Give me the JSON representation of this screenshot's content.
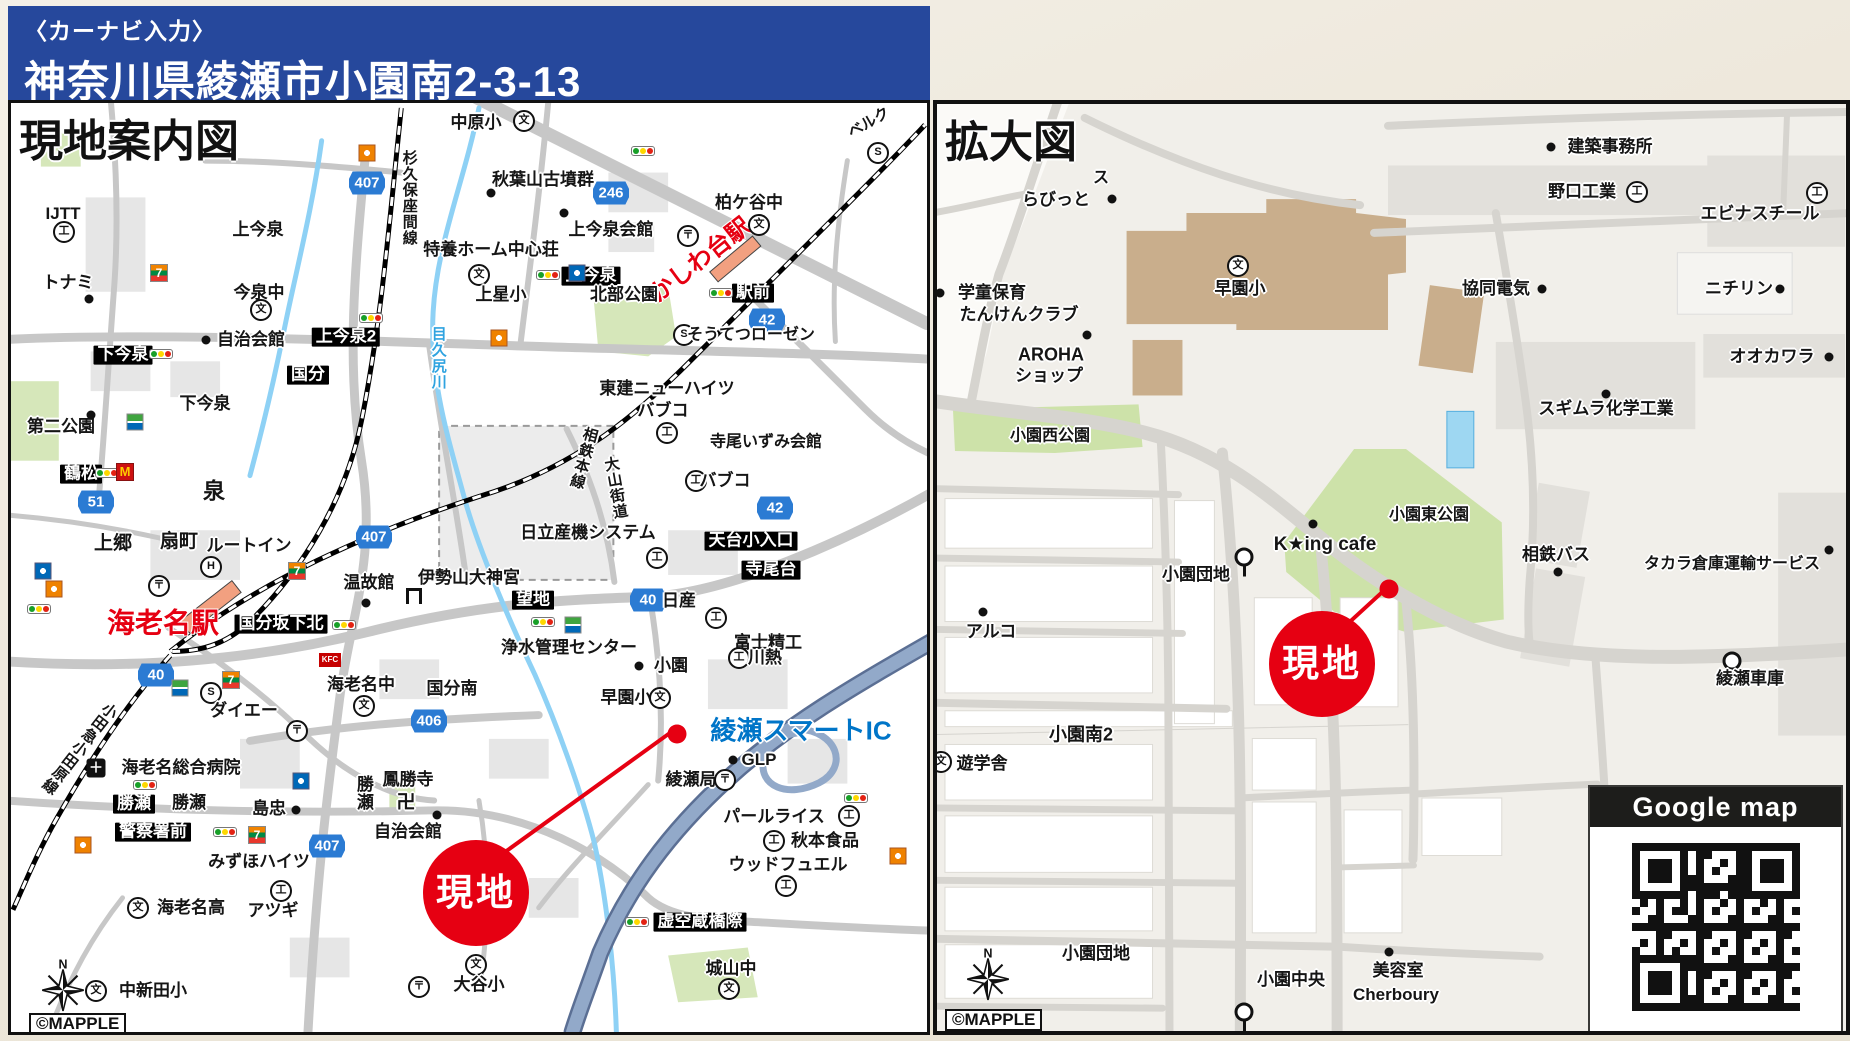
{
  "header": {
    "subtitle": "〈カーナビ入力〉",
    "title": "神奈川県綾瀬市小園南2-3-13"
  },
  "left_map": {
    "title": "現地案内図",
    "credit": "©MAPPLE",
    "labels": [
      {
        "k": "shield",
        "t": "407",
        "x": 356,
        "y": 80
      },
      {
        "k": "shield",
        "t": "246",
        "x": 600,
        "y": 90
      },
      {
        "k": "shield",
        "t": "42",
        "x": 756,
        "y": 217
      },
      {
        "k": "shield",
        "t": "51",
        "x": 85,
        "y": 399
      },
      {
        "k": "shield",
        "t": "407",
        "x": 363,
        "y": 434
      },
      {
        "k": "shield",
        "t": "40",
        "x": 145,
        "y": 572
      },
      {
        "k": "shield",
        "t": "40",
        "x": 637,
        "y": 497
      },
      {
        "k": "shield",
        "t": "42",
        "x": 764,
        "y": 405
      },
      {
        "k": "shield",
        "t": "406",
        "x": 418,
        "y": 618
      },
      {
        "k": "shield",
        "t": "407",
        "x": 316,
        "y": 743
      },
      {
        "k": "box",
        "t": "下今泉",
        "x": 112,
        "y": 252
      },
      {
        "k": "box",
        "t": "上今泉2",
        "x": 335,
        "y": 234
      },
      {
        "k": "box",
        "t": "国分",
        "x": 297,
        "y": 272
      },
      {
        "k": "box",
        "t": "鶴松",
        "x": 70,
        "y": 371
      },
      {
        "k": "box",
        "t": "上今泉",
        "x": 580,
        "y": 173
      },
      {
        "k": "box",
        "t": "駅前",
        "x": 742,
        "y": 190
      },
      {
        "k": "box",
        "t": "国分坂下北",
        "x": 270,
        "y": 521
      },
      {
        "k": "box",
        "t": "望地",
        "x": 522,
        "y": 497
      },
      {
        "k": "box",
        "t": "天台小入口",
        "x": 740,
        "y": 438
      },
      {
        "k": "box",
        "t": "寺尾台",
        "x": 760,
        "y": 467
      },
      {
        "k": "box",
        "t": "勝瀬",
        "x": 123,
        "y": 701
      },
      {
        "k": "box",
        "t": "警察署前",
        "x": 142,
        "y": 729
      },
      {
        "k": "box",
        "t": "虚空蔵橋際",
        "x": 689,
        "y": 819
      },
      {
        "k": "red",
        "t": "海老名駅",
        "x": 152,
        "y": 520,
        "s": 28
      },
      {
        "k": "red",
        "t": "かしわ台駅",
        "x": 690,
        "y": 158,
        "s": 24,
        "r": -38
      },
      {
        "k": "blue",
        "t": "綾瀬スマートIC",
        "x": 790,
        "y": 628,
        "s": 26
      },
      {
        "k": "rv",
        "t": "目久尻川",
        "x": 427,
        "y": 255,
        "s": 15
      },
      {
        "k": "v",
        "t": "杉久保座間線",
        "x": 398,
        "y": 95,
        "s": 15
      },
      {
        "k": "v",
        "t": "相鉄本線",
        "x": 572,
        "y": 355,
        "s": 15,
        "r": 15
      },
      {
        "k": "v",
        "t": "大山街道",
        "x": 604,
        "y": 385,
        "s": 15,
        "r": -10
      },
      {
        "k": "v",
        "t": "小田急小田原線",
        "x": 68,
        "y": 645,
        "s": 15,
        "r": 38
      },
      {
        "k": "v",
        "t": "勝瀬",
        "x": 352,
        "y": 690
      },
      {
        "k": "p",
        "t": "ベルク",
        "x": 858,
        "y": 20,
        "s": 15,
        "r": -30
      },
      {
        "k": "mark",
        "t": "S",
        "x": 867,
        "y": 50
      },
      {
        "k": "p",
        "t": "中原小",
        "x": 465,
        "y": 20
      },
      {
        "k": "mark",
        "t": "文",
        "x": 513,
        "y": 18
      },
      {
        "k": "p",
        "t": "秋葉山古墳群",
        "x": 532,
        "y": 77
      },
      {
        "k": "dot",
        "x": 480,
        "y": 90
      },
      {
        "k": "dot",
        "x": 553,
        "y": 110
      },
      {
        "k": "p",
        "t": "上今泉会館",
        "x": 600,
        "y": 127
      },
      {
        "k": "p",
        "t": "特養ホーム中心荘",
        "x": 480,
        "y": 147
      },
      {
        "k": "mark",
        "t": "文",
        "x": 468,
        "y": 172
      },
      {
        "k": "p",
        "t": "上星小",
        "x": 490,
        "y": 192
      },
      {
        "k": "p",
        "t": "北部公園",
        "x": 613,
        "y": 192
      },
      {
        "k": "p",
        "t": "柏ケ谷中",
        "x": 738,
        "y": 100
      },
      {
        "k": "mark",
        "t": "文",
        "x": 748,
        "y": 122
      },
      {
        "k": "mark",
        "t": "S",
        "x": 673,
        "y": 232
      },
      {
        "k": "p",
        "t": "そうてつローゼン",
        "x": 740,
        "y": 233,
        "s": 16
      },
      {
        "k": "p",
        "t": "東建ニューハイツ",
        "x": 656,
        "y": 286
      },
      {
        "k": "p",
        "t": "バブコ",
        "x": 652,
        "y": 308
      },
      {
        "k": "mark",
        "t": "工",
        "x": 656,
        "y": 330
      },
      {
        "k": "p",
        "t": "寺尾いずみ会館",
        "x": 755,
        "y": 340,
        "s": 16
      },
      {
        "k": "mark",
        "t": "工",
        "x": 685,
        "y": 378
      },
      {
        "k": "p",
        "t": "バブコ",
        "x": 714,
        "y": 378
      },
      {
        "k": "p",
        "t": "IJTT",
        "x": 52,
        "y": 111
      },
      {
        "k": "mark",
        "t": "工",
        "x": 53,
        "y": 129
      },
      {
        "k": "p",
        "t": "トナミ",
        "x": 57,
        "y": 180
      },
      {
        "k": "dot",
        "x": 78,
        "y": 196
      },
      {
        "k": "p",
        "t": "上今泉",
        "x": 247,
        "y": 127
      },
      {
        "k": "p",
        "t": "今泉中",
        "x": 248,
        "y": 190
      },
      {
        "k": "mark",
        "t": "文",
        "x": 250,
        "y": 207
      },
      {
        "k": "p",
        "t": "自治会館",
        "x": 240,
        "y": 237
      },
      {
        "k": "dot",
        "x": 195,
        "y": 237
      },
      {
        "k": "p",
        "t": "下今泉",
        "x": 194,
        "y": 301
      },
      {
        "k": "p",
        "t": "第二公園",
        "x": 50,
        "y": 324
      },
      {
        "k": "dot",
        "x": 80,
        "y": 312
      },
      {
        "k": "p",
        "t": "泉",
        "x": 203,
        "y": 389,
        "s": 22
      },
      {
        "k": "p",
        "t": "上郷",
        "x": 102,
        "y": 441,
        "s": 19
      },
      {
        "k": "p",
        "t": "扇町",
        "x": 168,
        "y": 439,
        "s": 19
      },
      {
        "k": "p",
        "t": "ルートイン",
        "x": 238,
        "y": 443
      },
      {
        "k": "mark",
        "t": "H",
        "x": 200,
        "y": 464
      },
      {
        "k": "p",
        "t": "温故館",
        "x": 358,
        "y": 480
      },
      {
        "k": "dot",
        "x": 355,
        "y": 500
      },
      {
        "k": "p",
        "t": "伊勢山大神宮",
        "x": 458,
        "y": 475
      },
      {
        "k": "torii",
        "x": 403,
        "y": 493
      },
      {
        "k": "p",
        "t": "日立産機システム",
        "x": 577,
        "y": 430
      },
      {
        "k": "mark",
        "t": "工",
        "x": 646,
        "y": 455
      },
      {
        "k": "p",
        "t": "日産",
        "x": 668,
        "y": 498
      },
      {
        "k": "mark",
        "t": "工",
        "x": 705,
        "y": 515
      },
      {
        "k": "p",
        "t": "富士精工",
        "x": 757,
        "y": 540
      },
      {
        "k": "p",
        "t": "浄水管理センター",
        "x": 558,
        "y": 545
      },
      {
        "k": "dot",
        "x": 628,
        "y": 563
      },
      {
        "k": "p",
        "t": "小園",
        "x": 660,
        "y": 563
      },
      {
        "k": "mark",
        "t": "工",
        "x": 728,
        "y": 555
      },
      {
        "k": "p",
        "t": "川熱",
        "x": 754,
        "y": 555
      },
      {
        "k": "p",
        "t": "海老名中",
        "x": 350,
        "y": 582
      },
      {
        "k": "mark",
        "t": "文",
        "x": 353,
        "y": 603
      },
      {
        "k": "p",
        "t": "国分南",
        "x": 441,
        "y": 586
      },
      {
        "k": "p",
        "t": "早園小",
        "x": 615,
        "y": 595
      },
      {
        "k": "mark",
        "t": "文",
        "x": 649,
        "y": 595
      },
      {
        "k": "mark",
        "t": "S",
        "x": 200,
        "y": 590
      },
      {
        "k": "p",
        "t": "ダイエー",
        "x": 233,
        "y": 608
      },
      {
        "k": "p",
        "t": "海老名総合病院",
        "x": 170,
        "y": 665
      },
      {
        "k": "hosp",
        "t": "＋",
        "x": 85,
        "y": 665
      },
      {
        "k": "p",
        "t": "勝瀬",
        "x": 178,
        "y": 700
      },
      {
        "k": "p",
        "t": "島忠",
        "x": 258,
        "y": 706
      },
      {
        "k": "dot",
        "x": 285,
        "y": 707
      },
      {
        "k": "p",
        "t": "みずほハイツ",
        "x": 248,
        "y": 759
      },
      {
        "k": "mark",
        "t": "文",
        "x": 127,
        "y": 805
      },
      {
        "k": "p",
        "t": "海老名高",
        "x": 180,
        "y": 805
      },
      {
        "k": "mark",
        "t": "工",
        "x": 270,
        "y": 788
      },
      {
        "k": "p",
        "t": "アツギ",
        "x": 262,
        "y": 808
      },
      {
        "k": "p",
        "t": "鳳勝寺",
        "x": 397,
        "y": 677
      },
      {
        "k": "p",
        "t": "卍",
        "x": 395,
        "y": 700,
        "s": 19
      },
      {
        "k": "dot",
        "x": 426,
        "y": 712
      },
      {
        "k": "p",
        "t": "自治会館",
        "x": 397,
        "y": 729
      },
      {
        "k": "mark",
        "t": "文",
        "x": 85,
        "y": 888
      },
      {
        "k": "p",
        "t": "中新田小",
        "x": 142,
        "y": 888
      },
      {
        "k": "mark",
        "t": "文",
        "x": 465,
        "y": 862
      },
      {
        "k": "p",
        "t": "大谷小",
        "x": 468,
        "y": 882
      },
      {
        "k": "mark",
        "t": "〒",
        "x": 408,
        "y": 884
      },
      {
        "k": "p",
        "t": "城山中",
        "x": 720,
        "y": 866
      },
      {
        "k": "mark",
        "t": "文",
        "x": 718,
        "y": 886
      },
      {
        "k": "p",
        "t": "GLP",
        "x": 748,
        "y": 657
      },
      {
        "k": "dot",
        "x": 722,
        "y": 657
      },
      {
        "k": "p",
        "t": "綾瀬局",
        "x": 680,
        "y": 677
      },
      {
        "k": "mark",
        "t": "〒",
        "x": 714,
        "y": 677
      },
      {
        "k": "p",
        "t": "パールライス",
        "x": 763,
        "y": 714
      },
      {
        "k": "mark",
        "t": "工",
        "x": 838,
        "y": 713
      },
      {
        "k": "mark",
        "t": "工",
        "x": 763,
        "y": 738
      },
      {
        "k": "p",
        "t": "秋本食品",
        "x": 814,
        "y": 738
      },
      {
        "k": "p",
        "t": "ウッドフュエル",
        "x": 777,
        "y": 762
      },
      {
        "k": "mark",
        "t": "工",
        "x": 775,
        "y": 783
      },
      {
        "k": "mark",
        "t": "〒",
        "x": 148,
        "y": 483
      },
      {
        "k": "mark",
        "t": "〒",
        "x": 677,
        "y": 133
      },
      {
        "k": "mark",
        "t": "〒",
        "x": 286,
        "y": 628
      },
      {
        "k": "signal",
        "x": 150,
        "y": 251
      },
      {
        "k": "signal",
        "x": 360,
        "y": 215
      },
      {
        "k": "signal",
        "x": 632,
        "y": 48
      },
      {
        "k": "signal",
        "x": 537,
        "y": 172
      },
      {
        "k": "signal",
        "x": 710,
        "y": 190
      },
      {
        "k": "signal",
        "x": 96,
        "y": 370
      },
      {
        "k": "signal",
        "x": 28,
        "y": 506
      },
      {
        "k": "signal",
        "x": 333,
        "y": 522
      },
      {
        "k": "signal",
        "x": 532,
        "y": 519
      },
      {
        "k": "signal",
        "x": 134,
        "y": 682
      },
      {
        "k": "signal",
        "x": 214,
        "y": 729
      },
      {
        "k": "signal",
        "x": 845,
        "y": 695
      },
      {
        "k": "signal",
        "x": 626,
        "y": 819
      },
      {
        "k": "seven",
        "t": "7",
        "x": 148,
        "y": 170
      },
      {
        "k": "seven",
        "t": "7",
        "x": 220,
        "y": 577
      },
      {
        "k": "seven",
        "t": "7",
        "x": 246,
        "y": 732
      },
      {
        "k": "seven",
        "t": "7",
        "x": 286,
        "y": 468
      },
      {
        "k": "mcd",
        "t": "M",
        "x": 114,
        "y": 369
      },
      {
        "k": "eneos",
        "x": 356,
        "y": 50
      },
      {
        "k": "eneos",
        "x": 488,
        "y": 235
      },
      {
        "k": "eneos",
        "x": 43,
        "y": 486
      },
      {
        "k": "eneos",
        "x": 72,
        "y": 742
      },
      {
        "k": "eneos",
        "x": 887,
        "y": 753
      },
      {
        "k": "kfc",
        "t": "KFC",
        "x": 319,
        "y": 557
      },
      {
        "k": "fam",
        "x": 124,
        "y": 319
      },
      {
        "k": "fam",
        "x": 169,
        "y": 585
      },
      {
        "k": "fam",
        "x": 562,
        "y": 522
      },
      {
        "k": "lawson",
        "x": 566,
        "y": 170
      },
      {
        "k": "lawson",
        "x": 32,
        "y": 468
      },
      {
        "k": "lawson",
        "x": 290,
        "y": 678
      },
      {
        "k": "reddot",
        "x": 666,
        "y": 631
      },
      {
        "k": "genchi",
        "t": "現地",
        "x": 465,
        "y": 790
      },
      {
        "k": "compass",
        "x": 52,
        "y": 882
      }
    ]
  },
  "right_map": {
    "title": "拡大図",
    "credit": "©MAPPLE",
    "google_box": {
      "title": "Google map"
    },
    "labels": [
      {
        "k": "p",
        "t": "ス",
        "x": 164,
        "y": 75,
        "s": 16
      },
      {
        "k": "p",
        "t": "らびっと",
        "x": 119,
        "y": 96
      },
      {
        "k": "dot",
        "x": 175,
        "y": 95
      },
      {
        "k": "dot",
        "x": 614,
        "y": 43
      },
      {
        "k": "p",
        "t": "建築事務所",
        "x": 673,
        "y": 43
      },
      {
        "k": "p",
        "t": "野口工業",
        "x": 645,
        "y": 88
      },
      {
        "k": "mark",
        "t": "工",
        "x": 700,
        "y": 88
      },
      {
        "k": "mark",
        "t": "工",
        "x": 880,
        "y": 89
      },
      {
        "k": "p",
        "t": "エビナスチール",
        "x": 823,
        "y": 110
      },
      {
        "k": "dot",
        "x": 3,
        "y": 189
      },
      {
        "k": "p",
        "t": "学童保育",
        "x": 55,
        "y": 189
      },
      {
        "k": "p",
        "t": "たんけんクラブ",
        "x": 82,
        "y": 211
      },
      {
        "k": "dot",
        "x": 150,
        "y": 231
      },
      {
        "k": "p",
        "t": "AROHA",
        "x": 114,
        "y": 251,
        "s": 18
      },
      {
        "k": "p",
        "t": "ショップ",
        "x": 112,
        "y": 272
      },
      {
        "k": "mark",
        "t": "文",
        "x": 301,
        "y": 162
      },
      {
        "k": "p",
        "t": "早園小",
        "x": 303,
        "y": 185
      },
      {
        "k": "p",
        "t": "協同電気",
        "x": 559,
        "y": 185
      },
      {
        "k": "dot",
        "x": 605,
        "y": 185
      },
      {
        "k": "p",
        "t": "ニチリン",
        "x": 802,
        "y": 185
      },
      {
        "k": "dot",
        "x": 843,
        "y": 185
      },
      {
        "k": "p",
        "t": "オオカワラ",
        "x": 835,
        "y": 253
      },
      {
        "k": "dot",
        "x": 892,
        "y": 253
      },
      {
        "k": "dot",
        "x": 669,
        "y": 290
      },
      {
        "k": "p",
        "t": "スギムラ化学工業",
        "x": 669,
        "y": 305
      },
      {
        "k": "p",
        "t": "小園西公園",
        "x": 113,
        "y": 333,
        "s": 16
      },
      {
        "k": "p",
        "t": "小園東公園",
        "x": 492,
        "y": 412,
        "s": 16
      },
      {
        "k": "dot",
        "x": 376,
        "y": 420
      },
      {
        "k": "p",
        "t": "K★ing cafe",
        "x": 388,
        "y": 441,
        "s": 19
      },
      {
        "k": "p",
        "t": "小園団地",
        "x": 259,
        "y": 471
      },
      {
        "k": "bus",
        "x": 307,
        "y": 453
      },
      {
        "k": "p",
        "t": "相鉄バス",
        "x": 619,
        "y": 451
      },
      {
        "k": "dot",
        "x": 621,
        "y": 468
      },
      {
        "k": "p",
        "t": "タカラ倉庫運輸サービス",
        "x": 795,
        "y": 461,
        "s": 16
      },
      {
        "k": "dot",
        "x": 892,
        "y": 446
      },
      {
        "k": "bus",
        "x": 795,
        "y": 538
      },
      {
        "k": "p",
        "t": "綾瀬車庫",
        "x": 813,
        "y": 575
      },
      {
        "k": "dot",
        "x": 46,
        "y": 508
      },
      {
        "k": "p",
        "t": "アルコ",
        "x": 54,
        "y": 528
      },
      {
        "k": "reddot",
        "x": 452,
        "y": 485
      },
      {
        "k": "genchi",
        "t": "現地",
        "x": 385,
        "y": 560
      },
      {
        "k": "p",
        "t": "小園南2",
        "x": 144,
        "y": 631,
        "s": 18
      },
      {
        "k": "mark",
        "t": "文",
        "x": 4,
        "y": 658
      },
      {
        "k": "p",
        "t": "遊学舎",
        "x": 45,
        "y": 660
      },
      {
        "k": "p",
        "t": "小園団地",
        "x": 159,
        "y": 850
      },
      {
        "k": "bus",
        "x": 307,
        "y": 870
      },
      {
        "k": "p",
        "t": "小園中央",
        "x": 354,
        "y": 876
      },
      {
        "k": "dot",
        "x": 452,
        "y": 848
      },
      {
        "k": "p",
        "t": "美容室",
        "x": 461,
        "y": 867
      },
      {
        "k": "p",
        "t": "Cherboury",
        "x": 459,
        "y": 891
      },
      {
        "k": "compass",
        "x": 51,
        "y": 870
      }
    ]
  }
}
